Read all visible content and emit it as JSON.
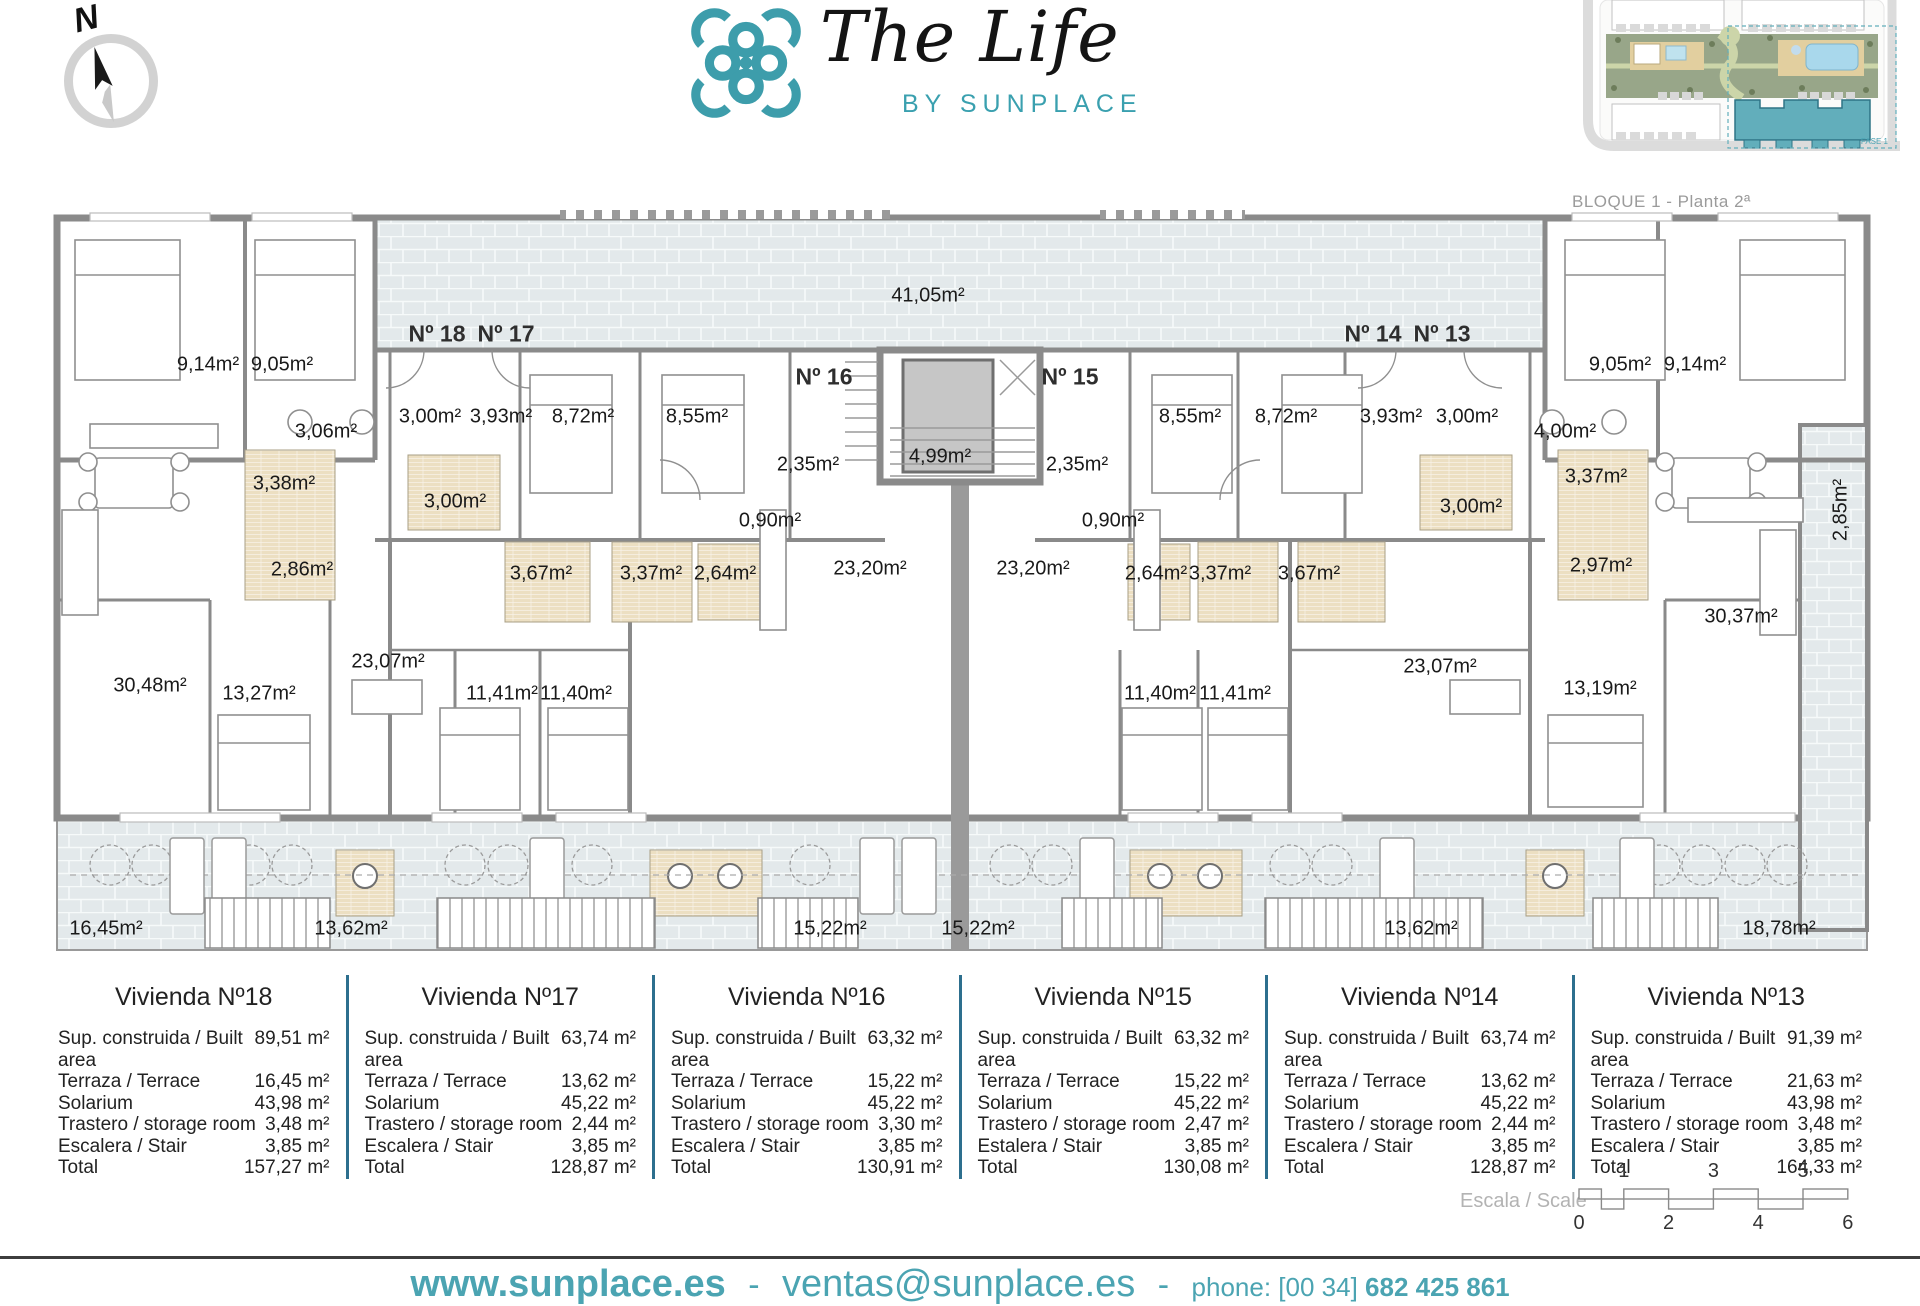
{
  "brand": {
    "accent": "#3aa0af",
    "building_highlight": "#5fadba",
    "wall_gray": "#8a8a8a",
    "terrace_tile": "#e3e9eb",
    "bath_tile": "#ecdfc2"
  },
  "compass": {
    "label": "N"
  },
  "logo": {
    "title": "The Life",
    "subtitle": "BY SUNPLACE"
  },
  "siteplan": {
    "caption": "BLOQUE 1 - Planta 2ª",
    "fase_label": "FASE 1"
  },
  "plan": {
    "unit_labels": [
      {
        "text": "Nº 18",
        "x": 437,
        "y": 334
      },
      {
        "text": "Nº 17",
        "x": 506,
        "y": 334
      },
      {
        "text": "Nº 16",
        "x": 824,
        "y": 377
      },
      {
        "text": "Nº 15",
        "x": 1070,
        "y": 377
      },
      {
        "text": "Nº 14",
        "x": 1373,
        "y": 334
      },
      {
        "text": "Nº 13",
        "x": 1442,
        "y": 334
      }
    ],
    "room_labels": [
      {
        "text": "41,05m²",
        "x": 928,
        "y": 296
      },
      {
        "text": "9,14m²",
        "x": 208,
        "y": 365
      },
      {
        "text": "9,05m²",
        "x": 282,
        "y": 365
      },
      {
        "text": "3,06m²",
        "x": 326,
        "y": 432
      },
      {
        "text": "3,00m²",
        "x": 430,
        "y": 417
      },
      {
        "text": "3,93m²",
        "x": 501,
        "y": 417
      },
      {
        "text": "8,72m²",
        "x": 583,
        "y": 417
      },
      {
        "text": "8,55m²",
        "x": 697,
        "y": 417
      },
      {
        "text": "2,35m²",
        "x": 808,
        "y": 465
      },
      {
        "text": "4,99m²",
        "x": 940,
        "y": 457
      },
      {
        "text": "2,35m²",
        "x": 1077,
        "y": 465
      },
      {
        "text": "3,38m²",
        "x": 284,
        "y": 484
      },
      {
        "text": "3,00m²",
        "x": 455,
        "y": 502
      },
      {
        "text": "0,90m²",
        "x": 770,
        "y": 521
      },
      {
        "text": "0,90m²",
        "x": 1113,
        "y": 521
      },
      {
        "text": "2,86m²",
        "x": 302,
        "y": 570
      },
      {
        "text": "3,67m²",
        "x": 541,
        "y": 574
      },
      {
        "text": "3,37m²",
        "x": 651,
        "y": 574
      },
      {
        "text": "2,64m²",
        "x": 725,
        "y": 574
      },
      {
        "text": "23,20m²",
        "x": 870,
        "y": 569
      },
      {
        "text": "23,20m²",
        "x": 1033,
        "y": 569
      },
      {
        "text": "2,64m²",
        "x": 1156,
        "y": 574
      },
      {
        "text": "3,37m²",
        "x": 1220,
        "y": 574
      },
      {
        "text": "3,67m²",
        "x": 1309,
        "y": 574
      },
      {
        "text": "8,55m²",
        "x": 1190,
        "y": 417
      },
      {
        "text": "8,72m²",
        "x": 1286,
        "y": 417
      },
      {
        "text": "3,93m²",
        "x": 1391,
        "y": 417
      },
      {
        "text": "3,00m²",
        "x": 1467,
        "y": 417
      },
      {
        "text": "9,05m²",
        "x": 1620,
        "y": 365
      },
      {
        "text": "9,14m²",
        "x": 1695,
        "y": 365
      },
      {
        "text": "4,00m²",
        "x": 1565,
        "y": 432
      },
      {
        "text": "3,00m²",
        "x": 1471,
        "y": 507
      },
      {
        "text": "3,37m²",
        "x": 1596,
        "y": 477
      },
      {
        "text": "2,97m²",
        "x": 1601,
        "y": 566
      },
      {
        "text": "30,48m²",
        "x": 150,
        "y": 686
      },
      {
        "text": "13,27m²",
        "x": 259,
        "y": 694
      },
      {
        "text": "23,07m²",
        "x": 388,
        "y": 662
      },
      {
        "text": "11,41m²",
        "x": 502,
        "y": 694
      },
      {
        "text": "11,40m²",
        "x": 576,
        "y": 694
      },
      {
        "text": "11,40m²",
        "x": 1160,
        "y": 694
      },
      {
        "text": "11,41m²",
        "x": 1235,
        "y": 694
      },
      {
        "text": "23,07m²",
        "x": 1440,
        "y": 667
      },
      {
        "text": "13,19m²",
        "x": 1600,
        "y": 689
      },
      {
        "text": "30,37m²",
        "x": 1741,
        "y": 617
      },
      {
        "text": "16,45m²",
        "x": 106,
        "y": 929
      },
      {
        "text": "13,62m²",
        "x": 351,
        "y": 929
      },
      {
        "text": "15,22m²",
        "x": 830,
        "y": 929
      },
      {
        "text": "15,22m²",
        "x": 978,
        "y": 929
      },
      {
        "text": "13,62m²",
        "x": 1421,
        "y": 929
      },
      {
        "text": "18,78m²",
        "x": 1779,
        "y": 929
      }
    ],
    "vertical_labels": [
      {
        "text": "2,85m²",
        "x": 1841,
        "y": 510
      }
    ]
  },
  "units": [
    {
      "title": "Vivienda Nº18",
      "rows": [
        {
          "label": "Sup. construida / Built area",
          "value": "89,51 m²"
        },
        {
          "label": "Terraza / Terrace",
          "value": "16,45 m²"
        },
        {
          "label": "Solarium",
          "value": "43,98 m²"
        },
        {
          "label": "Trastero / storage room",
          "value": "3,48 m²"
        },
        {
          "label": "Escalera / Stair",
          "value": "3,85 m²"
        },
        {
          "label": "Total",
          "value": "157,27 m²"
        }
      ]
    },
    {
      "title": "Vivienda Nº17",
      "rows": [
        {
          "label": "Sup. construida / Built area",
          "value": "63,74 m²"
        },
        {
          "label": "Terraza / Terrace",
          "value": "13,62 m²"
        },
        {
          "label": "Solarium",
          "value": "45,22 m²"
        },
        {
          "label": "Trastero / storage room",
          "value": "2,44 m²"
        },
        {
          "label": "Escalera / Stair",
          "value": "3,85 m²"
        },
        {
          "label": "Total",
          "value": "128,87 m²"
        }
      ]
    },
    {
      "title": "Vivienda Nº16",
      "rows": [
        {
          "label": "Sup. construida / Built area",
          "value": "63,32 m²"
        },
        {
          "label": "Terraza / Terrace",
          "value": "15,22 m²"
        },
        {
          "label": "Solarium",
          "value": "45,22 m²"
        },
        {
          "label": "Trastero / storage room",
          "value": "3,30 m²"
        },
        {
          "label": "Escalera / Stair",
          "value": "3,85 m²"
        },
        {
          "label": "Total",
          "value": "130,91 m²"
        }
      ]
    },
    {
      "title": "Vivienda Nº15",
      "rows": [
        {
          "label": "Sup. construida / Built area",
          "value": "63,32 m²"
        },
        {
          "label": "Terraza / Terrace",
          "value": "15,22 m²"
        },
        {
          "label": "Solarium",
          "value": "45,22 m²"
        },
        {
          "label": "Trastero / storage room",
          "value": "2,47 m²"
        },
        {
          "label": "Estalera / Stair",
          "value": "3,85 m²"
        },
        {
          "label": "Total",
          "value": "130,08 m²"
        }
      ]
    },
    {
      "title": "Vivienda Nº14",
      "rows": [
        {
          "label": "Sup. construida / Built area",
          "value": "63,74 m²"
        },
        {
          "label": "Terraza / Terrace",
          "value": "13,62 m²"
        },
        {
          "label": "Solarium",
          "value": "45,22 m²"
        },
        {
          "label": "Trastero / storage room",
          "value": "2,44 m²"
        },
        {
          "label": "Escalera / Stair",
          "value": "3,85 m²"
        },
        {
          "label": "Total",
          "value": "128,87 m²"
        }
      ]
    },
    {
      "title": "Vivienda Nº13",
      "rows": [
        {
          "label": "Sup. construida / Built area",
          "value": "91,39 m²"
        },
        {
          "label": "Terraza / Terrace",
          "value": "21,63 m²"
        },
        {
          "label": "Solarium",
          "value": "43,98 m²"
        },
        {
          "label": "Trastero / storage room",
          "value": "3,48 m²"
        },
        {
          "label": "Escalera / Stair",
          "value": "3,85 m²"
        },
        {
          "label": "Total",
          "value": "164,33 m²"
        }
      ]
    }
  ],
  "scale": {
    "label": "Escala / Scale",
    "top_ticks": [
      {
        "text": "1",
        "u": 1
      },
      {
        "text": "3",
        "u": 3
      },
      {
        "text": "5",
        "u": 5
      }
    ],
    "bottom_ticks": [
      {
        "text": "0",
        "u": 0
      },
      {
        "text": "2",
        "u": 2
      },
      {
        "text": "4",
        "u": 4
      },
      {
        "text": "6",
        "u": 6
      }
    ]
  },
  "footer": {
    "website": "www.sunplace.es",
    "separator": "-",
    "email": "ventas@sunplace.es",
    "phone_prefix": "phone: [00 34]",
    "phone_number": "682 425 861"
  }
}
